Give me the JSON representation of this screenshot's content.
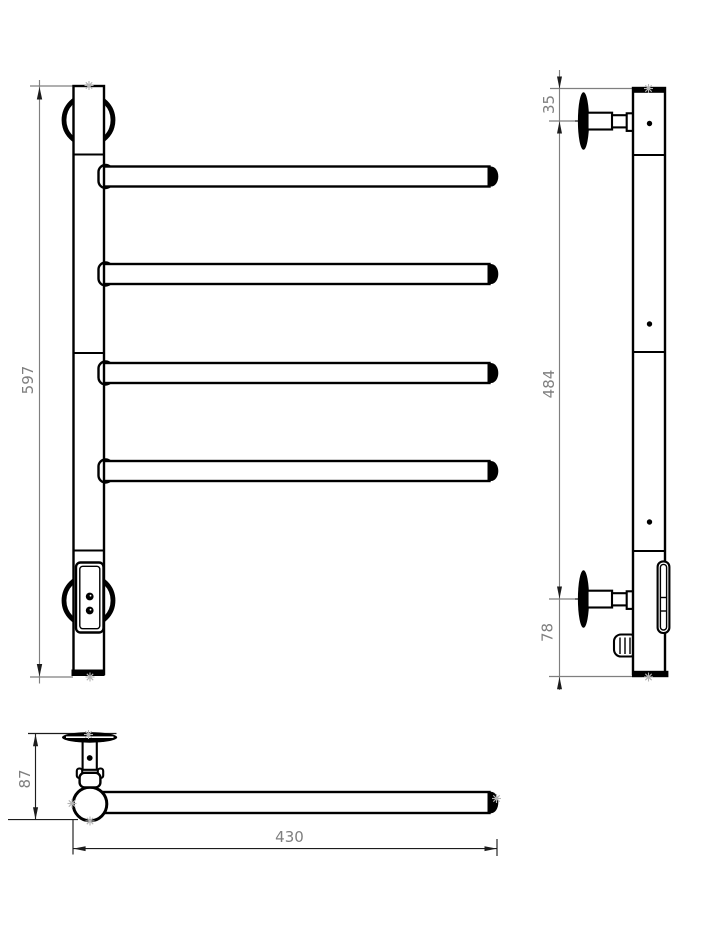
{
  "dimensions": {
    "front_height": "597",
    "side_wall_offset_top": "35",
    "side_bracket_span": "484",
    "side_wall_offset_bottom": "78",
    "bottom_depth": "87",
    "bottom_arm_length": "430"
  },
  "colors": {
    "line": "#000000",
    "dim": "#7f7f7f",
    "dimd": "#1c1c1c",
    "star": "#b5b5b5",
    "bg": "#ffffff"
  }
}
